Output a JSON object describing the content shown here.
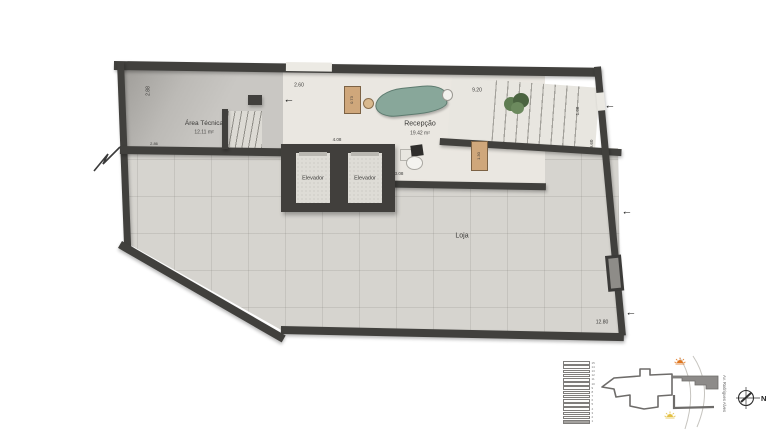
{
  "plan": {
    "rooms": {
      "area_tecnica": {
        "name": "Área Técnica",
        "area": "12.11 m²"
      },
      "recepcao": {
        "name": "Recepção",
        "area": "19.42 m²"
      },
      "loja": {
        "name": "Loja"
      },
      "elevator_left": {
        "name": "Elevador"
      },
      "elevator_right": {
        "name": "Elevador"
      }
    },
    "dimensions": {
      "entrance_width": "2.60",
      "reception_width": "9.20",
      "left_height": "2.88",
      "area_tecnica_corner": "2.86",
      "top_cabinet": "0.73",
      "side_cabinet": "1.30",
      "elevator_bank_width": "4.08",
      "reception_depth": "3.08",
      "stair_width": "1.66",
      "right_wall_height": "9.60",
      "shop_width": "12.80"
    },
    "entry_arrow": "←"
  },
  "legend": {
    "floor_stack": {
      "floors": [
        "15",
        "14",
        "13",
        "12",
        "11",
        "10",
        "9",
        "8",
        "7",
        "6",
        "5",
        "4",
        "3",
        "2",
        "1"
      ],
      "highlighted_index": 14
    },
    "site_map": {
      "street_label": "Av. Rodrigues Alves"
    },
    "compass": {
      "north_label": "N"
    }
  },
  "colors": {
    "wall": "#41403d",
    "loja_floor": "#d6d4cf",
    "reception_floor": "#eae7e1",
    "area_tecnica_floor": "#c6c4c0",
    "reception_desk": "#88a79a",
    "cabinet": "#cfa77b",
    "site_building_fill": "#8d8b89",
    "sun_orange": "#e0761f",
    "sun_yellow": "#e3c043"
  }
}
